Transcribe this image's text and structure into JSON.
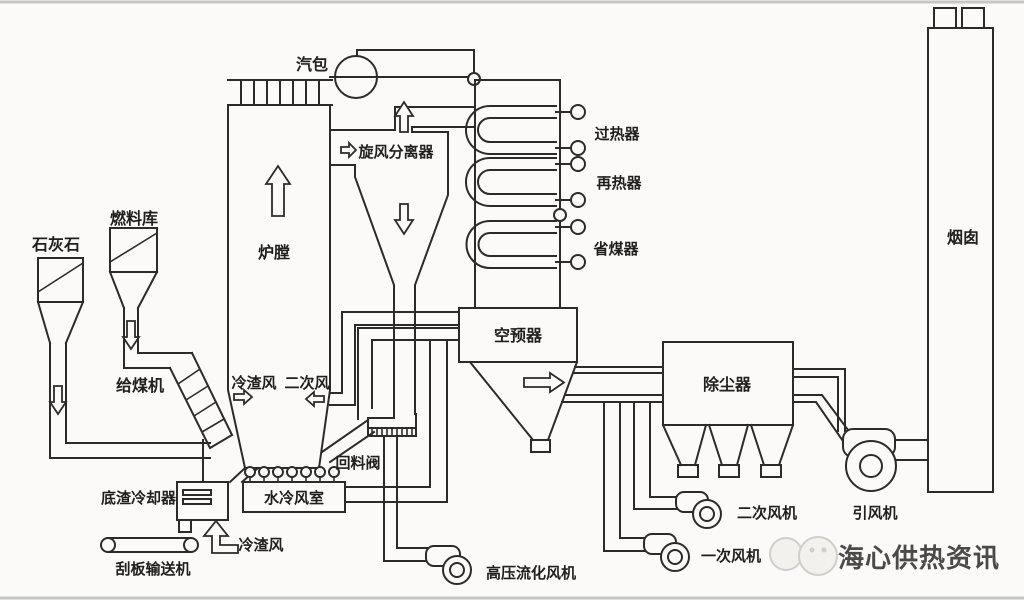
{
  "diagram": {
    "type": "circulating-fluidized-bed-boiler-system-schematic",
    "labels": {
      "steam_drum": "汽包",
      "cyclone_separator": "旋风分离器",
      "furnace": "炉膛",
      "superheater": "过热器",
      "reheater": "再热器",
      "economizer": "省煤器",
      "air_preheater": "空预器",
      "dust_collector": "除尘器",
      "chimney": "烟囱",
      "limestone_silo": "石灰石",
      "fuel_bunker": "燃料库",
      "coal_feeder": "给煤机",
      "cold_slag_air_furnace": "冷渣风",
      "secondary_air": "二次风",
      "return_valve": "回料阀",
      "water_cooled_windbox": "水冷风室",
      "bottom_slag_cooler": "底渣冷却器",
      "scraper_conveyor": "刮板输送机",
      "cold_slag_air_cooler": "冷渣风",
      "hp_fluidizing_fan": "高压流化风机",
      "primary_air_fan": "一次风机",
      "secondary_air_fan": "二次风机",
      "induced_draft_fan": "引风机"
    },
    "watermark": "海心供热资讯",
    "colors": {
      "line": "#2b2b2b",
      "label": "#1f1f1f",
      "background": "#fbfaf8",
      "border": "#c6c6c6",
      "watermark_text": "#4a4a4a",
      "watermark_bubble": "#d0cecb"
    }
  }
}
